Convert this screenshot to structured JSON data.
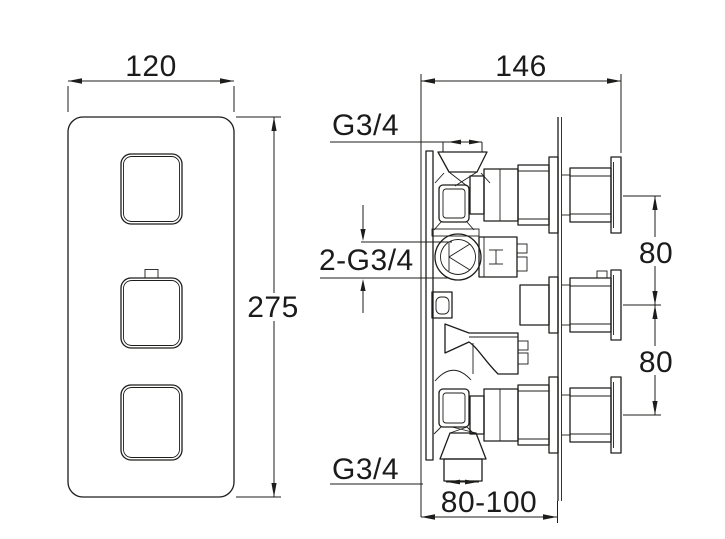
{
  "drawing": {
    "line_color": "#1d1d1b",
    "background": "#ffffff",
    "front_view": {
      "width_dim": "120",
      "height_dim": "275"
    },
    "side_view": {
      "depth_dim": "146",
      "top_port_thread": "G3/4",
      "side_port_thread": "2-G3/4",
      "bottom_port_thread": "G3/4",
      "port_spacing_upper": "80",
      "port_spacing_lower": "80",
      "installation_depth_range": "80-100"
    }
  }
}
